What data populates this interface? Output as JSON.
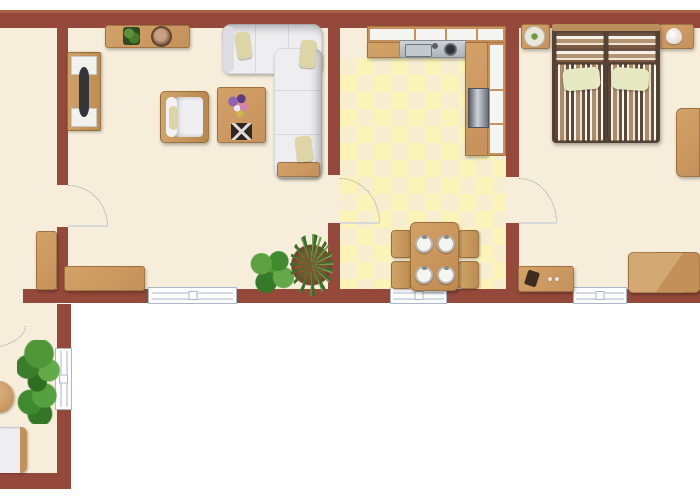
{
  "meta": {
    "type": "apartment-floor-plan",
    "width_px": 700,
    "height_px": 500,
    "visible_text": "none"
  },
  "colors": {
    "outside": "#ffffff",
    "wall": "#95493a",
    "wallLight": "#aa5f4a",
    "floor": "#f6eedb",
    "tileA": "#f6eecf",
    "tileB": "#fcf3b8",
    "wood": "#c6915c",
    "woodLight": "#d2a267",
    "sofa": "#eeeef1",
    "cushion": "#ded5a6",
    "bedBase": "#554237",
    "pillowGreen": "#e7e9c2",
    "windowFrame": "#aab8cc",
    "doorArc": "#9a9a9a",
    "plantGreen": "#4f9939",
    "metal": "#c3c7cc"
  },
  "scene": {
    "rooms": [
      {
        "id": "living-room",
        "items": [
          "tv-sideboard-with-tv",
          "wall-shelf",
          "potted-plant",
          "round-portrait",
          "corner-sofa",
          "accent-pillows",
          "armchair",
          "side-table",
          "flower-bouquet",
          "game-board",
          "tall-cabinet",
          "sideboard",
          "leafy-plant",
          "spiky-plant"
        ],
        "doors": 1
      },
      {
        "id": "kitchen",
        "items": [
          "upper-cabinet-row",
          "countertop",
          "double-sink-with-faucet",
          "stove",
          "right-counter-column",
          "dining-table"
        ],
        "dining_chairs": 4,
        "place_settings": 4,
        "floor": "checkerboard-tiles",
        "doors": 1
      },
      {
        "id": "bedroom",
        "items": [
          "double-bed-striped",
          "striped-pillows",
          "green-pillows",
          "nightstand-left-with-plant-plate",
          "nightstand-right-with-shell-lamp",
          "wardrobe",
          "low-tv-cabinet",
          "dresser"
        ],
        "striped_pillows": 2,
        "green_pillows": 2,
        "doors": 1
      },
      {
        "id": "hallway-corridor",
        "items": [
          "tall-green-plant",
          "white-bench-sofa",
          "round-table-partial"
        ],
        "doors": 1
      }
    ],
    "window_count": 4,
    "door_count": 4
  }
}
